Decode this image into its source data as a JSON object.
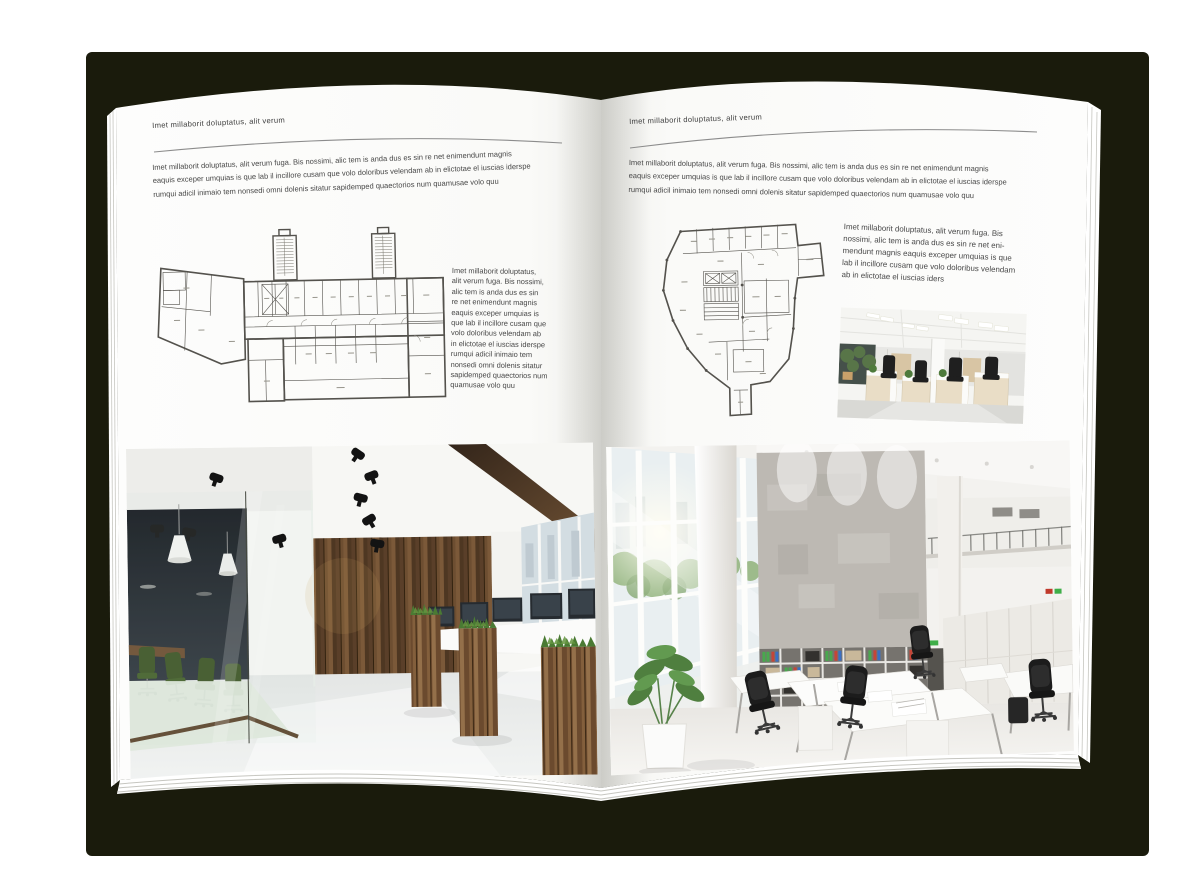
{
  "cover_color": "#1a1b0c",
  "left_page": {
    "header": "Imet millaborit doluptatus, alit verum",
    "intro_lines": [
      "Imet millaborit doluptatus, alit verum fuga. Bis nossimi, alic tem is anda dus es sin re net enimendunt magnis",
      "eaquis exceper umquias is que lab il incillore cusam que volo doloribus velendam ab in elictotae el iuscias iderspe",
      "rumqui adicil inimaio tem nonsedi omni dolenis sitatur sapidemped quaectorios num quamusae volo quu"
    ],
    "side_text_lines": [
      "Imet millaborit doluptatus,",
      "alit verum fuga. Bis nossimi,",
      "alic tem is anda dus es sin",
      "re net enimendunt magnis",
      "eaquis exceper umquias is",
      "que lab il incillore cusam que",
      "volo doloribus velendam ab",
      "in elictotae el iuscias iderspe",
      "rumqui adicil inimaio tem",
      "nonsedi omni dolenis sitatur",
      "sapidemped quaectorios num",
      "quamusae volo quu"
    ],
    "figures": {
      "floorplan": "rectangular-building-floor-plan",
      "photo": "dark-loft-office-interior-photo"
    }
  },
  "right_page": {
    "header": "Imet millaborit doluptatus, alit verum",
    "intro_lines": [
      "Imet millaborit doluptatus, alit verum fuga. Bis nossimi, alic tem is anda dus es sin re net enimendunt magnis",
      "eaquis exceper umquias is que lab il incillore cusam que volo doloribus velendam ab in elictotae el iuscias iderspe",
      "rumqui adicil inimaio tem nonsedi omni dolenis sitatur sapidemped quaectorios num quamusae volo quu"
    ],
    "side_text_lines": [
      "Imet millaborit doluptatus, alit verum fuga. Bis",
      "nossimi, alic tem is anda dus es sin re net eni-",
      "mendunt magnis eaquis exceper umquias is que",
      "lab il incillore cusam que volo doloribus velendam",
      "ab in elictotae el iuscias iders"
    ],
    "figures": {
      "floorplan": "irregular-building-floor-plan",
      "photo_small": "white-office-desk-row-photo",
      "photo_large": "bright-open-space-office-photo"
    }
  }
}
